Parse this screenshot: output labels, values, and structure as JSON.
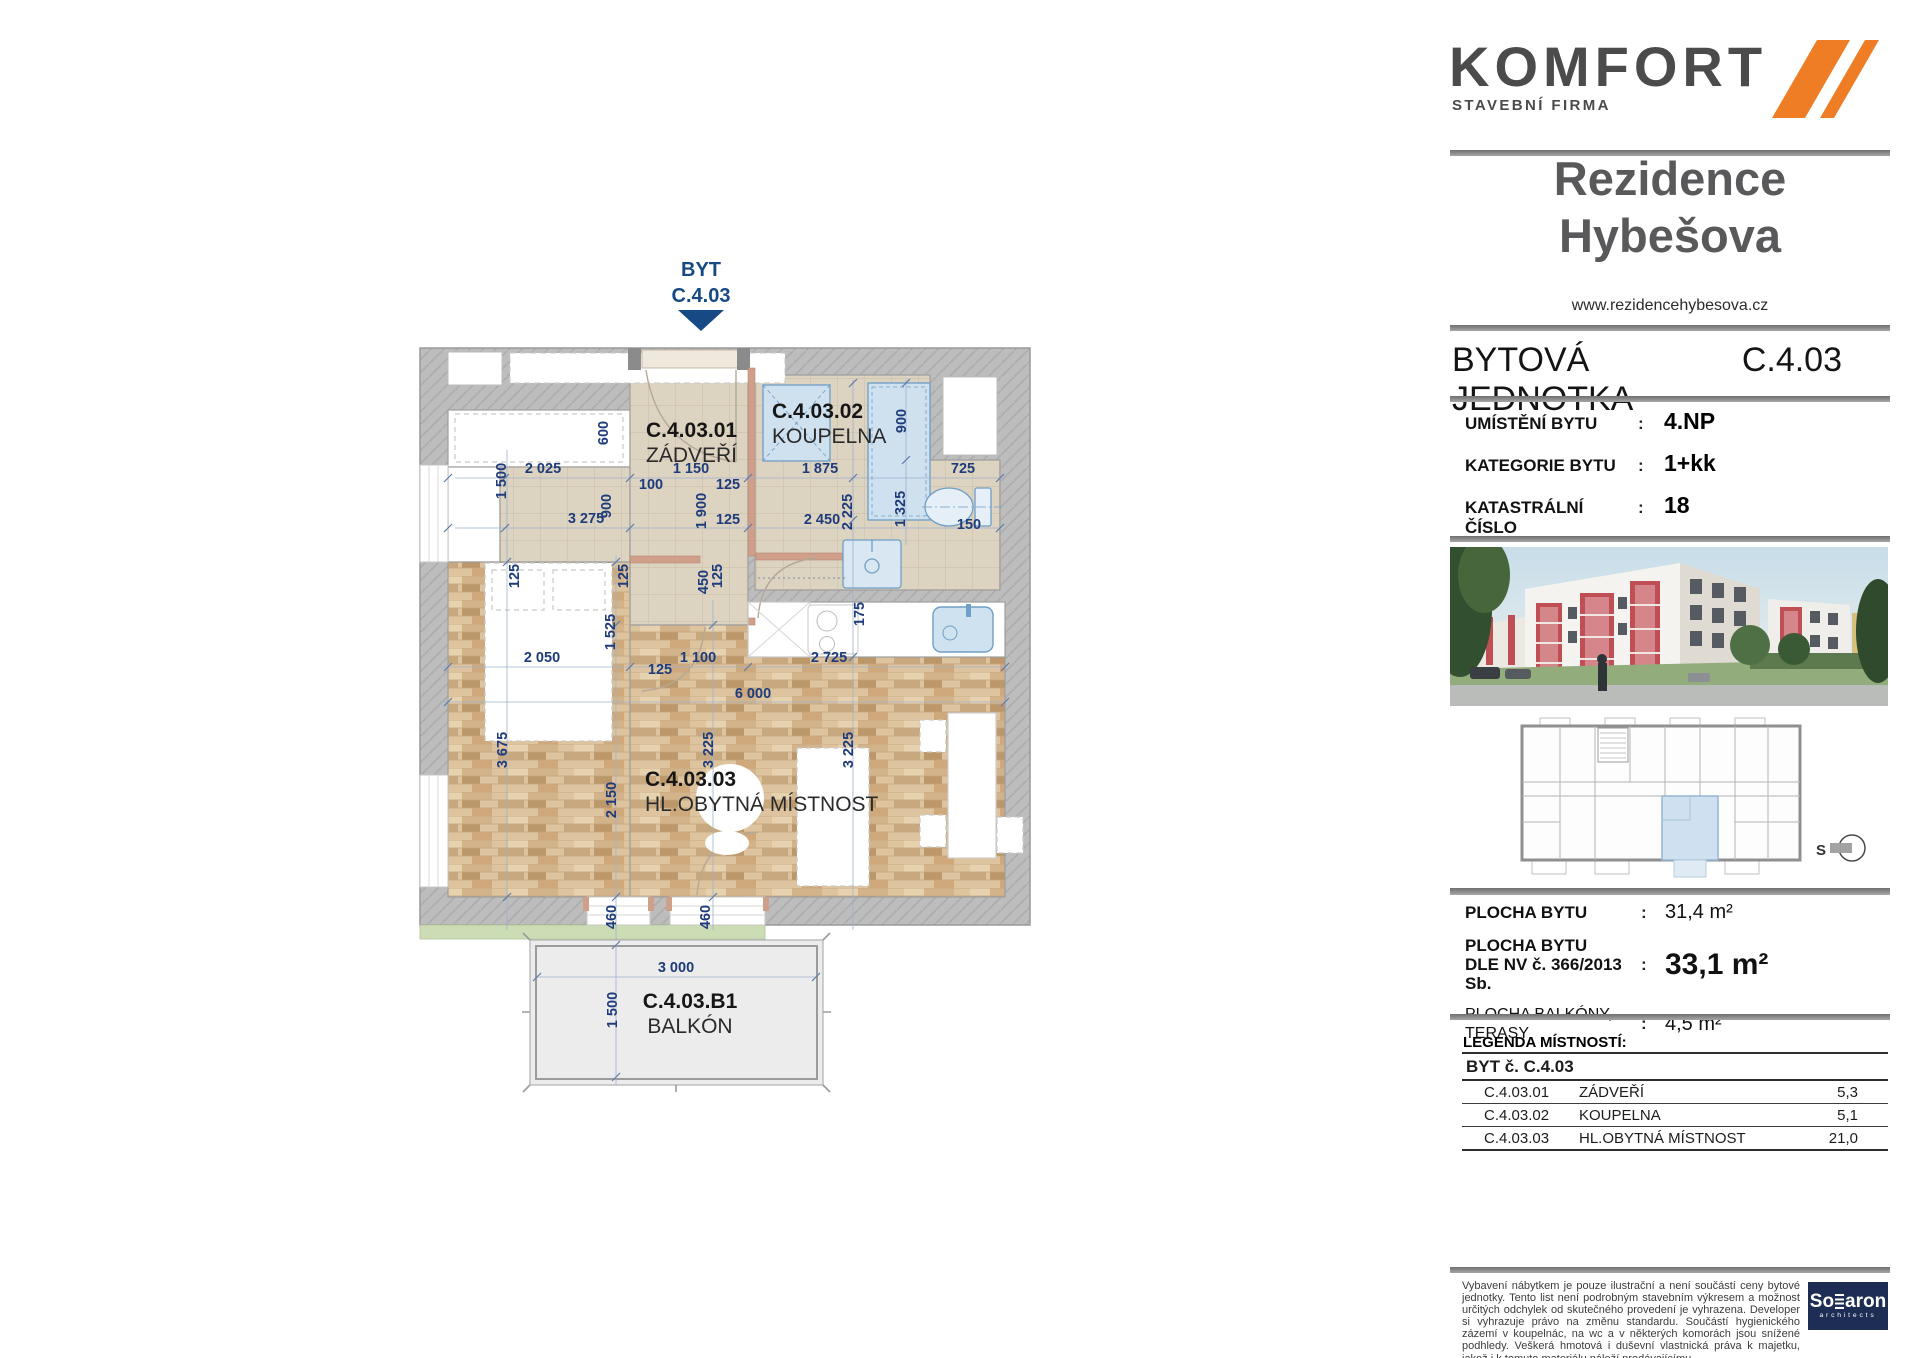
{
  "colors": {
    "accent_orange": "#ee7d25",
    "brand_gray": "#4b4b4b",
    "dim_navy": "#1e3c7c",
    "flag_navy": "#174a85",
    "rule_gray": "#8d8d8d",
    "wall_gray": "#bdbdbd",
    "fixture_blue": "#6f9ec6",
    "grass_green": "#ccdcb4",
    "unit_highlight": "#cfe0f0",
    "solaron_navy": "#1d2d53"
  },
  "brand": {
    "name": "KOMFORT",
    "subtitle": "STAVEBNÍ FIRMA"
  },
  "project": {
    "title_line1": "Rezidence",
    "title_line2": "Hybešova",
    "website": "www.rezidencehybesova.cz"
  },
  "unit": {
    "heading": "BYTOVÁ JEDNOTKA",
    "code": "C.4.03"
  },
  "info": {
    "colon": ":",
    "rows": [
      {
        "label": "UMÍSTĚNÍ BYTU",
        "value": "4.NP"
      },
      {
        "label": "KATEGORIE BYTU",
        "value": "1+kk"
      },
      {
        "label": "KATASTRÁLNÍ ČÍSLO",
        "value": "18"
      }
    ]
  },
  "areas": {
    "colon": ":",
    "rows": [
      {
        "label_lines": [
          "PLOCHA BYTU"
        ],
        "value": "31,4",
        "unit": "m²",
        "bold_label": true,
        "big_value": false
      },
      {
        "label_lines": [
          "PLOCHA BYTU",
          "DLE NV č. 366/2013 Sb."
        ],
        "value": "33,1",
        "unit": "m²",
        "bold_label": true,
        "big_value": true
      },
      {
        "label_lines": [
          "PLOCHA BALKÓNY, TERASY"
        ],
        "value": "4,5",
        "unit": "m²",
        "bold_label": false,
        "big_value": false
      }
    ]
  },
  "legend": {
    "title": "LEGENDA MÍSTNOSTÍ:",
    "group": "BYT č. C.4.03",
    "rows": [
      {
        "code": "C.4.03.01",
        "name": "ZÁDVEŘÍ",
        "area": "5,3"
      },
      {
        "code": "C.4.03.02",
        "name": "KOUPELNA",
        "area": "5,1"
      },
      {
        "code": "C.4.03.03",
        "name": "HL.OBYTNÁ MÍSTNOST",
        "area": "21,0"
      }
    ]
  },
  "footer": {
    "disclaimer": "Vybavení nábytkem je pouze ilustrační a není součástí ceny bytové jednotky. Tento list není podrobným stavebním výkresem a možnost určitých odchylek od skutečného provedení je vyhrazena. Developer si vyhrazuje právo na změnu standardu. Součástí hygienického zázemí v koupelnác, na wc a v některých komorách jsou snížené podhledy. Veškerá hmotová i duševní vlastnická práva k majetku, jakož i k tomuto materiálu náleží prodávajícímu.",
    "solaron": {
      "pre": "So",
      "post": "aron",
      "subtitle": "architects"
    }
  },
  "locator": {
    "north_label": "S"
  },
  "plan": {
    "flag": {
      "line1": "BYT",
      "line2": "C.4.03"
    },
    "rooms": [
      {
        "code": "C.4.03.01",
        "name": "ZÁDVEŘÍ",
        "x": 646,
        "y": 437,
        "anchor": "start"
      },
      {
        "code": "C.4.03.02",
        "name": "KOUPELNA",
        "x": 772,
        "y": 418,
        "anchor": "start"
      },
      {
        "code": "C.4.03.03",
        "name": "HL.OBYTNÁ MÍSTNOST",
        "x": 645,
        "y": 786,
        "anchor": "start"
      },
      {
        "code": "C.4.03.B1",
        "name": "BALKÓN",
        "x": 690,
        "y": 1008,
        "anchor": "middle"
      }
    ],
    "dimensions": [
      {
        "t": "600",
        "x": 608,
        "y": 433,
        "v": 1
      },
      {
        "t": "1 500",
        "x": 506,
        "y": 481,
        "v": 1
      },
      {
        "t": "2 025",
        "x": 543,
        "y": 473
      },
      {
        "t": "900",
        "x": 611,
        "y": 506,
        "v": 1
      },
      {
        "t": "3 275",
        "x": 586,
        "y": 523
      },
      {
        "t": "100",
        "x": 651,
        "y": 489
      },
      {
        "t": "1 150",
        "x": 691,
        "y": 473
      },
      {
        "t": "125",
        "x": 728,
        "y": 489
      },
      {
        "t": "1 900",
        "x": 706,
        "y": 511,
        "v": 1
      },
      {
        "t": "125",
        "x": 728,
        "y": 524
      },
      {
        "t": "1 875",
        "x": 820,
        "y": 473
      },
      {
        "t": "900",
        "x": 906,
        "y": 421,
        "v": 1
      },
      {
        "t": "725",
        "x": 963,
        "y": 473
      },
      {
        "t": "2 225",
        "x": 852,
        "y": 512,
        "v": 1
      },
      {
        "t": "1 325",
        "x": 905,
        "y": 509,
        "v": 1
      },
      {
        "t": "2 450",
        "x": 822,
        "y": 524
      },
      {
        "t": "150",
        "x": 969,
        "y": 529
      },
      {
        "t": "125",
        "x": 519,
        "y": 576,
        "v": 1
      },
      {
        "t": "125",
        "x": 628,
        "y": 576,
        "v": 1
      },
      {
        "t": "450",
        "x": 708,
        "y": 582,
        "v": 1
      },
      {
        "t": "125",
        "x": 722,
        "y": 576,
        "v": 1
      },
      {
        "t": "1 525",
        "x": 615,
        "y": 632,
        "v": 1
      },
      {
        "t": "175",
        "x": 864,
        "y": 614,
        "v": 1
      },
      {
        "t": "2 050",
        "x": 542,
        "y": 662
      },
      {
        "t": "125",
        "x": 660,
        "y": 674
      },
      {
        "t": "1 100",
        "x": 698,
        "y": 662
      },
      {
        "t": "2 725",
        "x": 829,
        "y": 662
      },
      {
        "t": "6 000",
        "x": 753,
        "y": 698
      },
      {
        "t": "3 675",
        "x": 507,
        "y": 750,
        "v": 1
      },
      {
        "t": "3 225",
        "x": 713,
        "y": 750,
        "v": 1
      },
      {
        "t": "3 225",
        "x": 853,
        "y": 750,
        "v": 1
      },
      {
        "t": "2 150",
        "x": 616,
        "y": 800,
        "v": 1
      },
      {
        "t": "460",
        "x": 616,
        "y": 917,
        "v": 1
      },
      {
        "t": "460",
        "x": 710,
        "y": 917,
        "v": 1
      },
      {
        "t": "3 000",
        "x": 676,
        "y": 972
      },
      {
        "t": "1 500",
        "x": 617,
        "y": 1010,
        "v": 1
      }
    ]
  }
}
